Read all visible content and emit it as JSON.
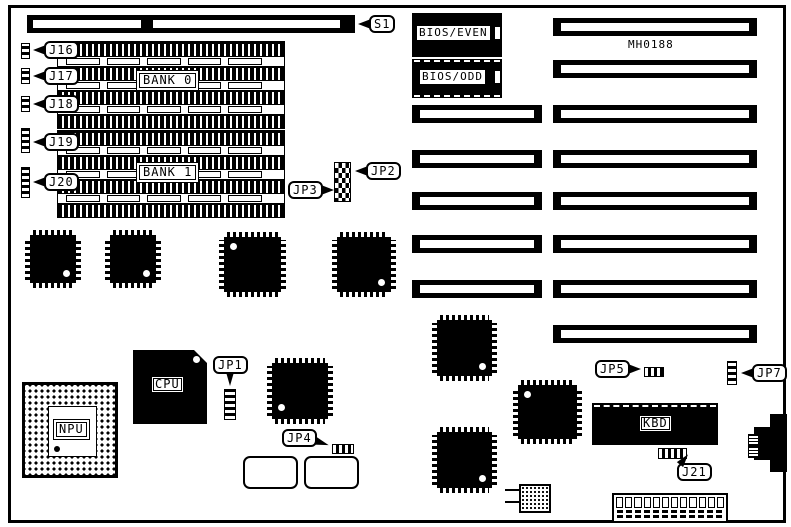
{
  "colors": {
    "ink": "#000000",
    "paper": "#ffffff"
  },
  "board": {
    "part_number": "MH0188"
  },
  "memory": {
    "bank0": "BANK 0",
    "bank1": "BANK 1"
  },
  "chips": {
    "bios_even": "BIOS/EVEN",
    "bios_odd": "BIOS/ODD",
    "cpu": "CPU",
    "npu": "NPU",
    "kbd": "KBD"
  },
  "callouts": {
    "s1": "S1",
    "j16": "J16",
    "j17": "J17",
    "j18": "J18",
    "j19": "J19",
    "j20": "J20",
    "j21": "J21",
    "jp1": "JP1",
    "jp2": "JP2",
    "jp3": "JP3",
    "jp4": "JP4",
    "jp5": "JP5",
    "jp7": "JP7"
  }
}
